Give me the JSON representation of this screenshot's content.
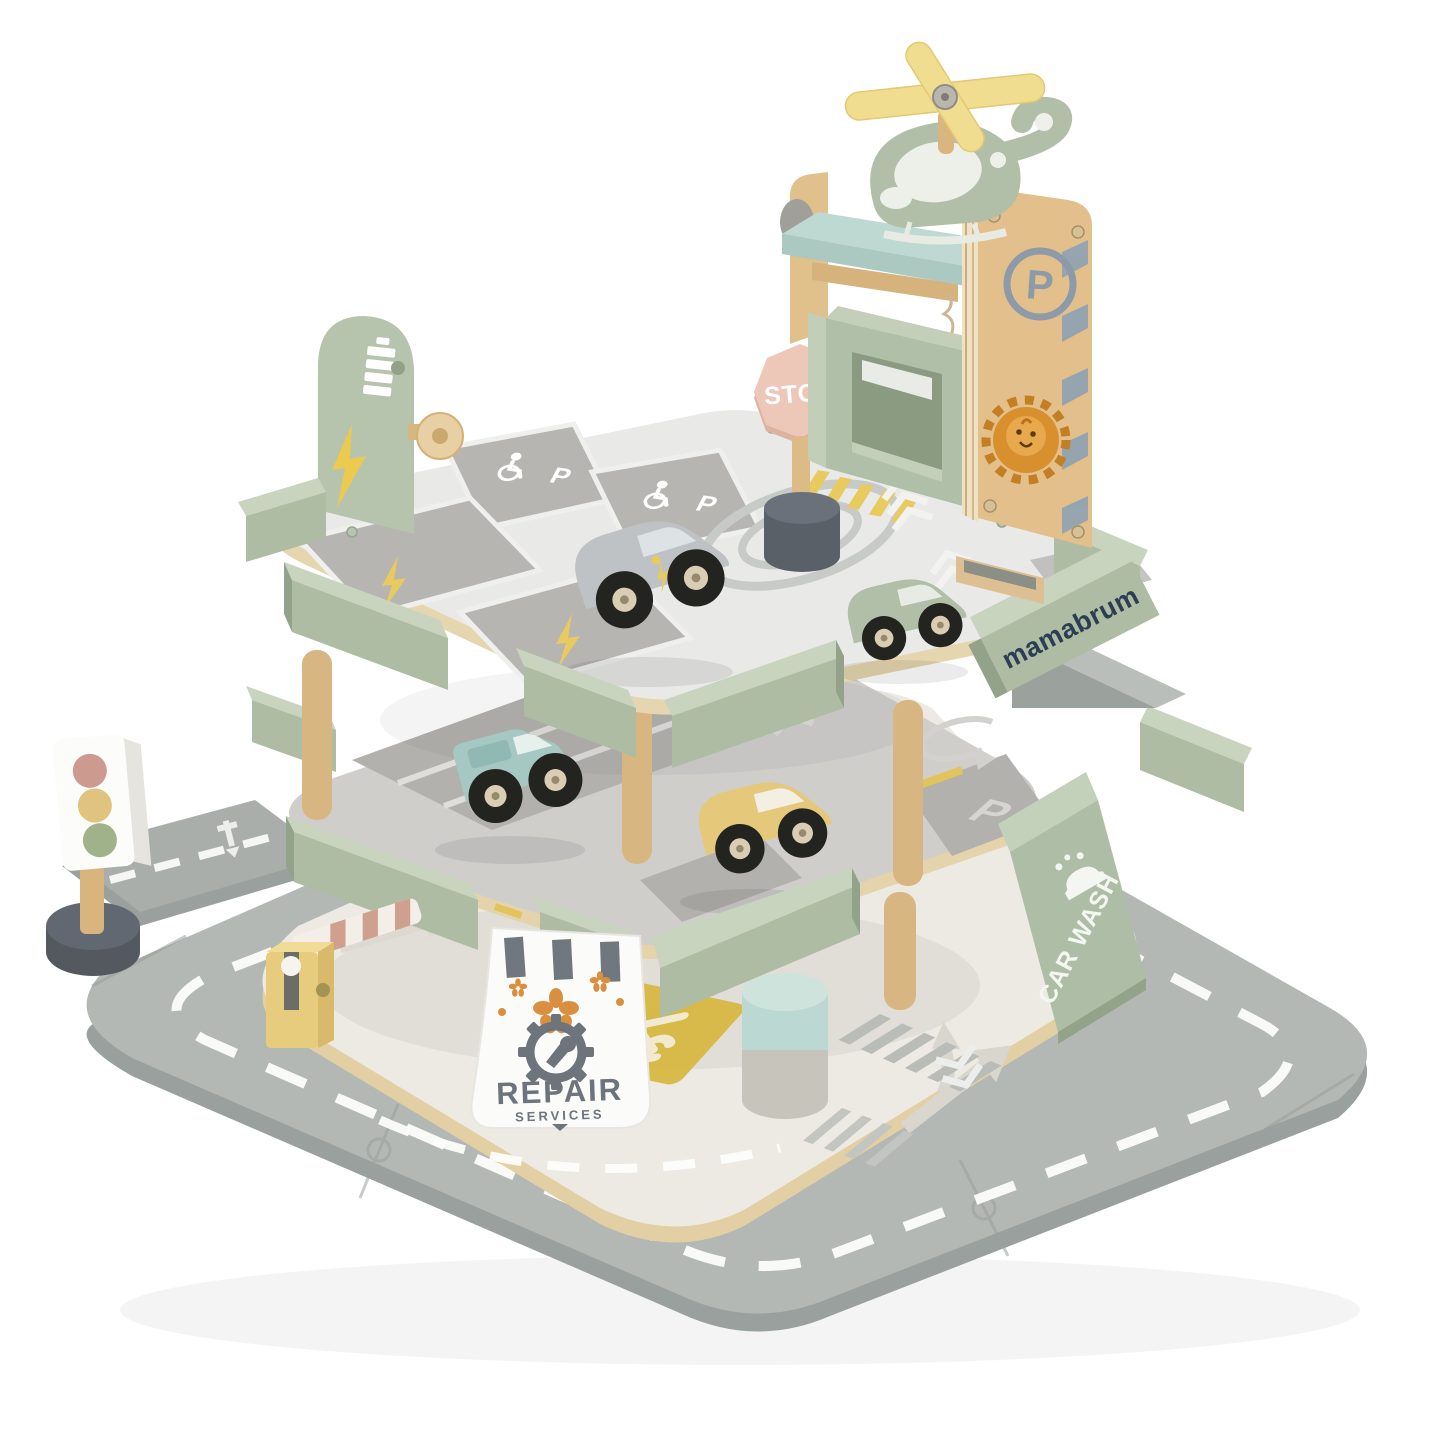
{
  "scene": {
    "background_color": "#ffffff",
    "subject": "wooden toy multi-level parking garage playset with helicopter pad, elevator tower, road mat, cars and accessories"
  },
  "labels": {
    "stop": "STOP",
    "parking_letter": "P",
    "brand": "mamabrum",
    "car_wash": "CAR WASH",
    "repair_line1": "REPAIR",
    "repair_line2": "SERVICES"
  },
  "icons": {
    "helicopter": "svg-toy-helicopter",
    "rotor-icon": "svg-crossed-blades",
    "parking-circle-icon": "svg-ring-with-letter",
    "lion-icon": "svg-orange-circle-face",
    "wheelchair-icon": "svg-figure-with-wheel",
    "lightning-icon": "svg-bolt-polygon",
    "battery-icon": "svg-stacked-bars",
    "gear-icon": "svg-toothed-ring",
    "wrench-icon": "svg-spanner",
    "tools-icon": "svg-crossed-tools",
    "car-wash-icon": "svg-car-with-bubbles",
    "traffic-light": "svg-three-lamps",
    "chevron-marking": "svg-double-arrows",
    "helipad-marking": "svg-concentric-ellipses"
  },
  "colors": {
    "sage_green": "#aebca4",
    "sage_light": "#c9d4bf",
    "mint": "#bed9d1",
    "wood": "#d9b57e",
    "plywood": "#ecdcb4",
    "road_gray": "#b3b8b5",
    "base_cream": "#edeae3",
    "deck_white": "#e9eae8",
    "marking_gray": "#b5b4b1",
    "accent_yellow": "#e8ca5e",
    "stop_salmon": "#edc7b7",
    "logo_navy": "#2e3e52",
    "sign_gray": "#6d747b",
    "car_teal": "#a6c8c3",
    "car_yellow": "#e6c87a",
    "car_silver": "#bfc2c4",
    "lion_orange": "#d88f2e",
    "chevron_blue": "#8fa3b3",
    "light_red": "#cd9a90",
    "light_amber": "#e0c37e",
    "light_green": "#9fb289"
  }
}
